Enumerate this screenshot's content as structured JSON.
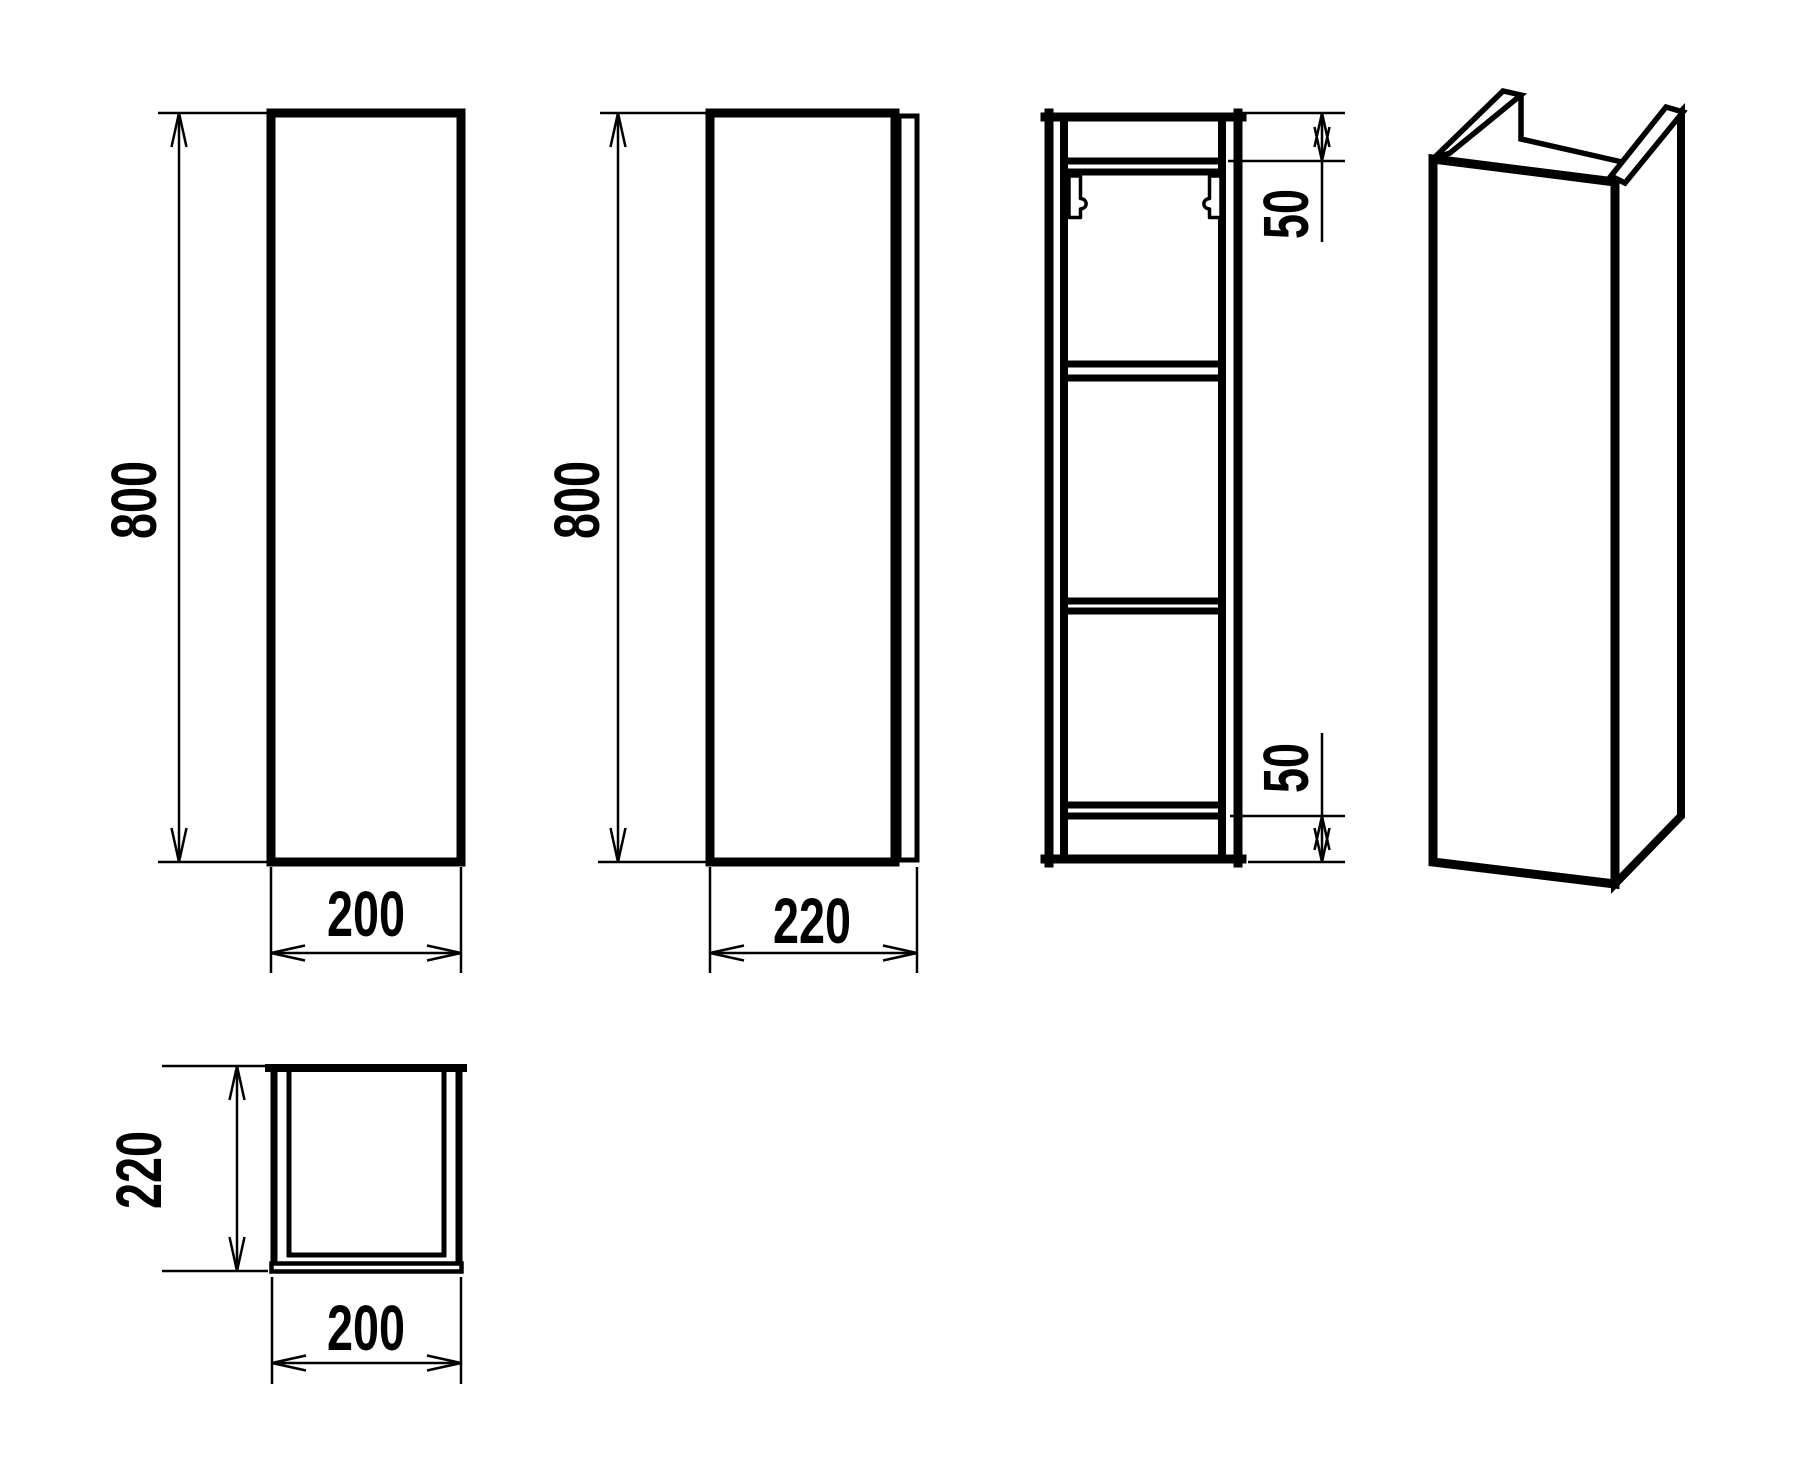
{
  "colors": {
    "line": "#000000",
    "background": "#ffffff"
  },
  "dims": {
    "front_height": "800",
    "front_width": "200",
    "side_height": "800",
    "side_depth": "220",
    "section_top_gap": "50",
    "section_bottom_gap": "50",
    "top_depth": "220",
    "top_width": "200"
  }
}
